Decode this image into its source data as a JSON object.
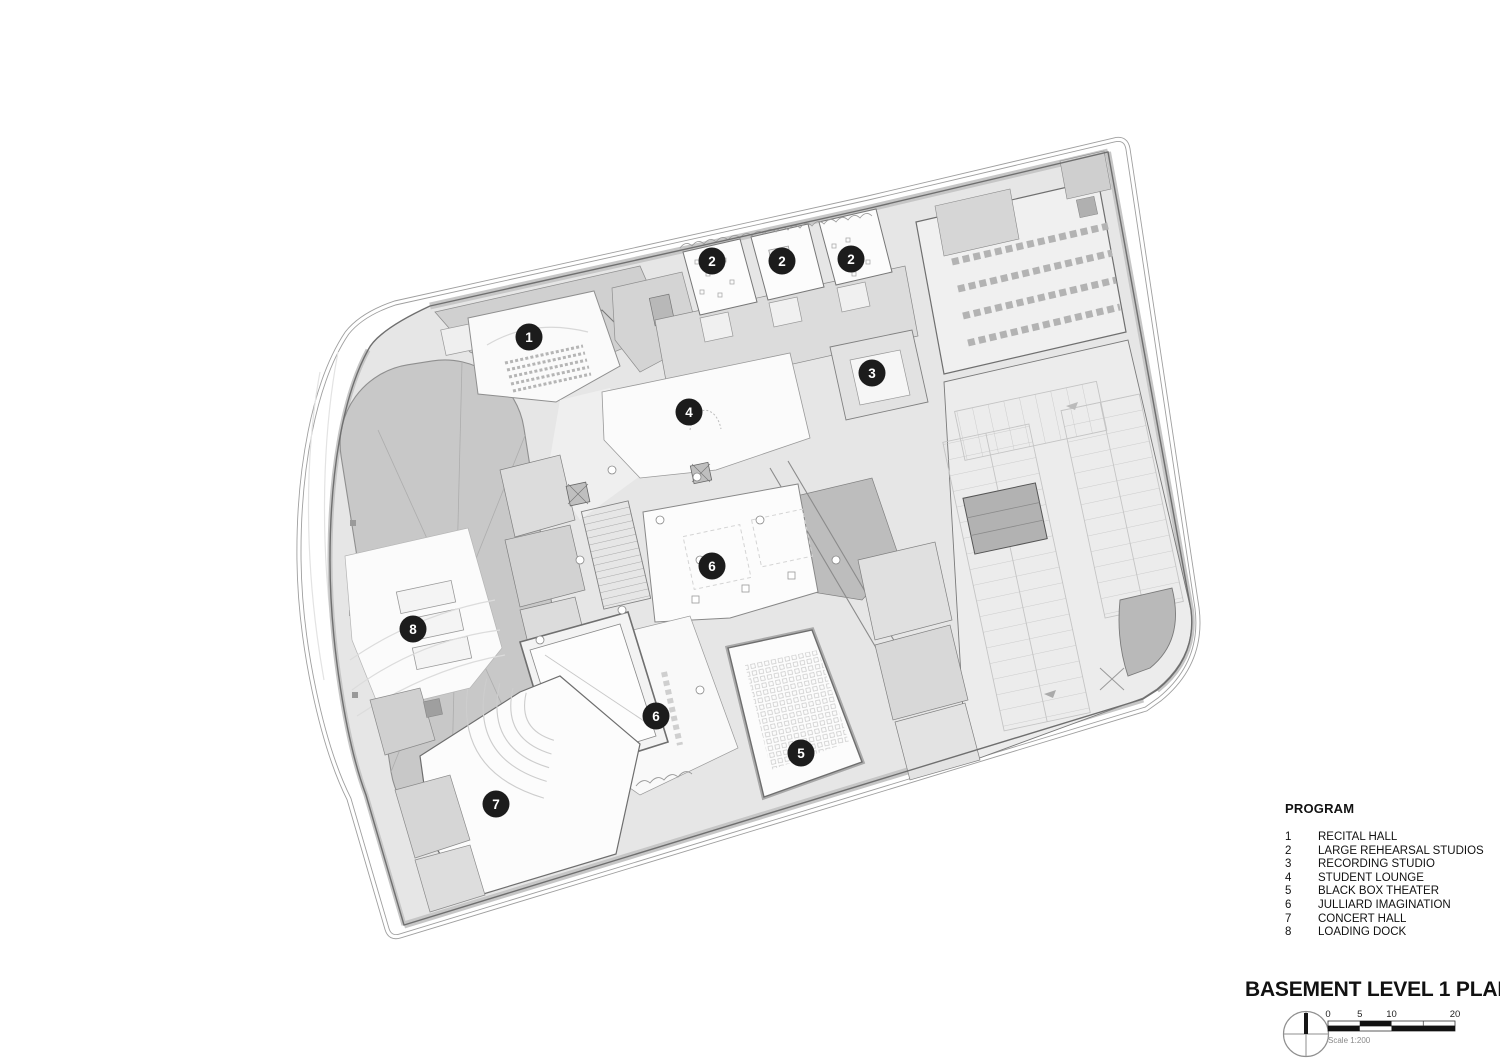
{
  "plan": {
    "name": "basement-level-1-floor-plan",
    "markers": [
      {
        "label": "1"
      },
      {
        "label": "2"
      },
      {
        "label": "2"
      },
      {
        "label": "2"
      },
      {
        "label": "3"
      },
      {
        "label": "4"
      },
      {
        "label": "6"
      },
      {
        "label": "8"
      },
      {
        "label": "6"
      },
      {
        "label": "5"
      },
      {
        "label": "7"
      }
    ]
  },
  "legend": {
    "title": "PROGRAM",
    "items": [
      {
        "num": "1",
        "label": "RECITAL HALL"
      },
      {
        "num": "2",
        "label": "LARGE REHEARSAL STUDIOS"
      },
      {
        "num": "3",
        "label": "RECORDING STUDIO"
      },
      {
        "num": "4",
        "label": "STUDENT LOUNGE"
      },
      {
        "num": "5",
        "label": "BLACK BOX THEATER"
      },
      {
        "num": "6",
        "label": "JULLIARD IMAGINATION"
      },
      {
        "num": "7",
        "label": "CONCERT HALL"
      },
      {
        "num": "8",
        "label": "LOADING DOCK"
      }
    ]
  },
  "titleblock": {
    "title": "BASEMENT LEVEL 1 PLAN"
  },
  "scalebar": {
    "labels": [
      "0",
      "5",
      "10",
      "20"
    ],
    "caption": "Scale 1:200"
  },
  "icons": {
    "north": "north-arrow-icon"
  },
  "colors": {
    "marker_bg": "#1c1c1c",
    "marker_text": "#ffffff",
    "ink": "#111111",
    "muted": "#9a9a9a",
    "building": "#e6e6e6",
    "dark_zone": "#c7c7c7",
    "wall": "#6f6f6f"
  }
}
